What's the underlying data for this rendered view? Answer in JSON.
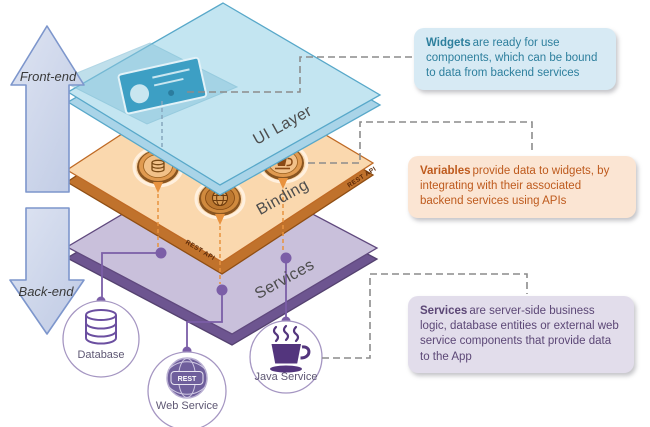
{
  "arrows": {
    "front": "Front-end",
    "back": "Back-end"
  },
  "layers": {
    "ui": {
      "label": "UI Layer"
    },
    "binding": {
      "label": "Binding",
      "edge_left": "REST API",
      "edge_right": "REST API"
    },
    "services": {
      "label": "Services"
    }
  },
  "callouts": {
    "widgets": {
      "title": "Widgets",
      "body": "are ready for use components, which can be bound to data from backend services"
    },
    "variables": {
      "title": "Variables",
      "body": "provide data to widgets, by integrating with their associated backend services using APIs"
    },
    "services": {
      "title": "Services",
      "body": "are server-side business logic, database entities or external web service components that provide data to the App"
    }
  },
  "backend_nodes": {
    "database": {
      "label": "Database"
    },
    "web_service": {
      "label": "Web Service",
      "badge": "REST"
    },
    "java_service": {
      "label": "Java Service"
    }
  },
  "colors": {
    "ui_layer_fill": "#C3E5F1",
    "ui_layer_edge": "#58A8C9",
    "binding_fill": "#FAD8AE",
    "binding_edge": "#BF6A25",
    "services_fill": "#C9C0DB",
    "services_edge": "#60497E",
    "callout_widgets_bg": "#D7EAF4",
    "callout_widgets_text": "#2D7F9D",
    "callout_variables_bg": "#FBE5D3",
    "callout_variables_text": "#BE5A1D",
    "callout_services_bg": "#E2DDEB",
    "callout_services_text": "#5C4776",
    "connector_purple": "#7B5EA7",
    "connector_orange": "#E8923E",
    "connector_gray": "#8C8C8C",
    "arrow_fill": "#CDD6EA",
    "arrow_border": "#7D96CC"
  }
}
